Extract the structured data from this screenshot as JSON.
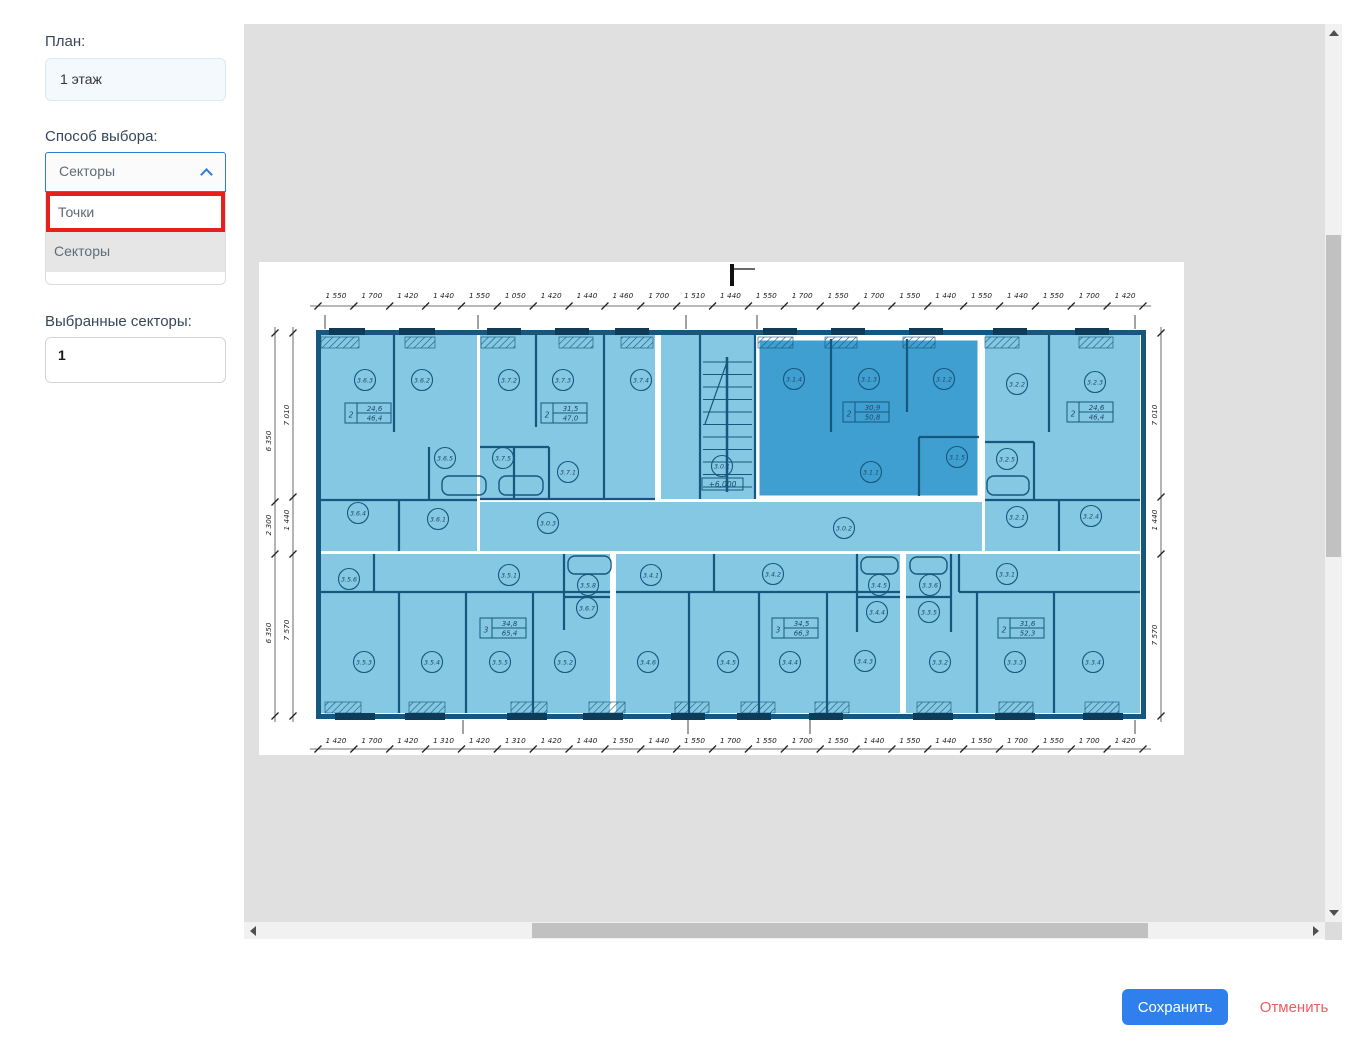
{
  "sidebar": {
    "plan_label": "План:",
    "plan_value": "1 этаж",
    "method_label": "Способ выбора:",
    "method_value": "Секторы",
    "options": [
      {
        "label": "Точки",
        "highlighted": true
      },
      {
        "label": "Секторы",
        "selected": true
      }
    ],
    "selected_label": "Выбранные секторы:",
    "selected_value": "1"
  },
  "actions": {
    "save": "Сохранить",
    "cancel": "Отменить"
  },
  "colors": {
    "accent_blue": "#2f80ed",
    "cancel_red": "#ec5d5d",
    "highlight_red": "#e8201d",
    "select_border": "#2e7cd6",
    "plan_light": "#85c8e3",
    "plan_dark_sector": "#3f9fd0",
    "plan_line": "#15577e",
    "plan_window": "#0e3c58"
  },
  "floor_plan": {
    "top_dims": [
      "1 550",
      "1 700",
      "1 420",
      "1 440",
      "1 550",
      "1 050",
      "1 420",
      "1 440",
      "1 460",
      "1 700",
      "1 510",
      "1 440",
      "1 550",
      "1 700",
      "1 550",
      "1 700",
      "1 550",
      "1 440",
      "1 550",
      "1 440",
      "1 550",
      "1 700",
      "1 420"
    ],
    "bottom_dims": [
      "1 420",
      "1 700",
      "1 420",
      "1 310",
      "1 420",
      "1 310",
      "1 420",
      "1 440",
      "1 550",
      "1 440",
      "1 550",
      "1 700",
      "1 550",
      "1 700",
      "1 550",
      "1 440",
      "1 550",
      "1 440",
      "1 550",
      "1 700",
      "1 550",
      "1 700",
      "1 420"
    ],
    "left_outer_dims": [
      "6 350",
      "2 300",
      "6 350"
    ],
    "left_inner_dims": [
      "7 010",
      "1 440",
      "7 570"
    ],
    "right_dims": [
      "7 010",
      "1 440",
      "7 570"
    ],
    "elevation": "+6,000",
    "rooms": [
      {
        "label": "3.6.3",
        "x": 106,
        "y": 118
      },
      {
        "label": "3.6.2",
        "x": 163,
        "y": 118
      },
      {
        "label": "3.7.2",
        "x": 250,
        "y": 118
      },
      {
        "label": "3.7.3",
        "x": 304,
        "y": 118
      },
      {
        "label": "3.7.4",
        "x": 382,
        "y": 118
      },
      {
        "label": "3.6.5",
        "x": 186,
        "y": 196
      },
      {
        "label": "3.7.5",
        "x": 244,
        "y": 196
      },
      {
        "label": "3.7.1",
        "x": 309,
        "y": 210
      },
      {
        "label": "3.6.4",
        "x": 99,
        "y": 251
      },
      {
        "label": "3.6.1",
        "x": 179,
        "y": 257
      },
      {
        "label": "3.0.1",
        "x": 463,
        "y": 204
      },
      {
        "label": "3.1.4",
        "x": 535,
        "y": 117
      },
      {
        "label": "3.1.3",
        "x": 610,
        "y": 117
      },
      {
        "label": "3.1.2",
        "x": 685,
        "y": 117
      },
      {
        "label": "3.1.5",
        "x": 698,
        "y": 195
      },
      {
        "label": "3.1.1",
        "x": 612,
        "y": 210
      },
      {
        "label": "3.2.2",
        "x": 758,
        "y": 122
      },
      {
        "label": "3.2.3",
        "x": 836,
        "y": 120
      },
      {
        "label": "3.2.5",
        "x": 748,
        "y": 197
      },
      {
        "label": "3.2.1",
        "x": 758,
        "y": 255
      },
      {
        "label": "3.2.4",
        "x": 832,
        "y": 254
      },
      {
        "label": "3.0.3",
        "x": 289,
        "y": 261
      },
      {
        "label": "3.0.2",
        "x": 585,
        "y": 266
      },
      {
        "label": "3.5.6",
        "x": 90,
        "y": 317
      },
      {
        "label": "3.5.1",
        "x": 250,
        "y": 313
      },
      {
        "label": "3.5.8",
        "x": 329,
        "y": 323
      },
      {
        "label": "3.6.7",
        "x": 328,
        "y": 346
      },
      {
        "label": "3.5.3",
        "x": 105,
        "y": 400
      },
      {
        "label": "3.5.4",
        "x": 173,
        "y": 400
      },
      {
        "label": "3.5.5",
        "x": 241,
        "y": 400
      },
      {
        "label": "3.5.2",
        "x": 306,
        "y": 400
      },
      {
        "label": "3.4.1",
        "x": 392,
        "y": 313
      },
      {
        "label": "3.4.2",
        "x": 514,
        "y": 312
      },
      {
        "label": "3.4.5",
        "x": 620,
        "y": 323
      },
      {
        "label": "3.3.6",
        "x": 671,
        "y": 323
      },
      {
        "label": "3.4.4",
        "x": 618,
        "y": 350
      },
      {
        "label": "3.3.5",
        "x": 670,
        "y": 350
      },
      {
        "label": "3.4.6",
        "x": 389,
        "y": 400
      },
      {
        "label": "3.4.5",
        "x": 469,
        "y": 400
      },
      {
        "label": "3.4.4",
        "x": 531,
        "y": 400
      },
      {
        "label": "3.4.3",
        "x": 606,
        "y": 399
      },
      {
        "label": "3.3.1",
        "x": 748,
        "y": 312
      },
      {
        "label": "3.3.2",
        "x": 681,
        "y": 400
      },
      {
        "label": "3.3.3",
        "x": 756,
        "y": 400
      },
      {
        "label": "3.3.4",
        "x": 834,
        "y": 400
      }
    ],
    "stamps": [
      {
        "rooms": "2",
        "a1": "24,6",
        "a2": "46,4",
        "x": 109,
        "y": 151
      },
      {
        "rooms": "2",
        "a1": "31,5",
        "a2": "47,0",
        "x": 305,
        "y": 151
      },
      {
        "rooms": "2",
        "a1": "30,9",
        "a2": "50,8",
        "x": 607,
        "y": 150
      },
      {
        "rooms": "2",
        "a1": "24,6",
        "a2": "46,4",
        "x": 831,
        "y": 150
      },
      {
        "rooms": "3",
        "a1": "34,8",
        "a2": "65,4",
        "x": 244,
        "y": 366
      },
      {
        "rooms": "3",
        "a1": "34,5",
        "a2": "66,3",
        "x": 536,
        "y": 366
      },
      {
        "rooms": "2",
        "a1": "31,6",
        "a2": "52,3",
        "x": 762,
        "y": 366
      }
    ]
  }
}
